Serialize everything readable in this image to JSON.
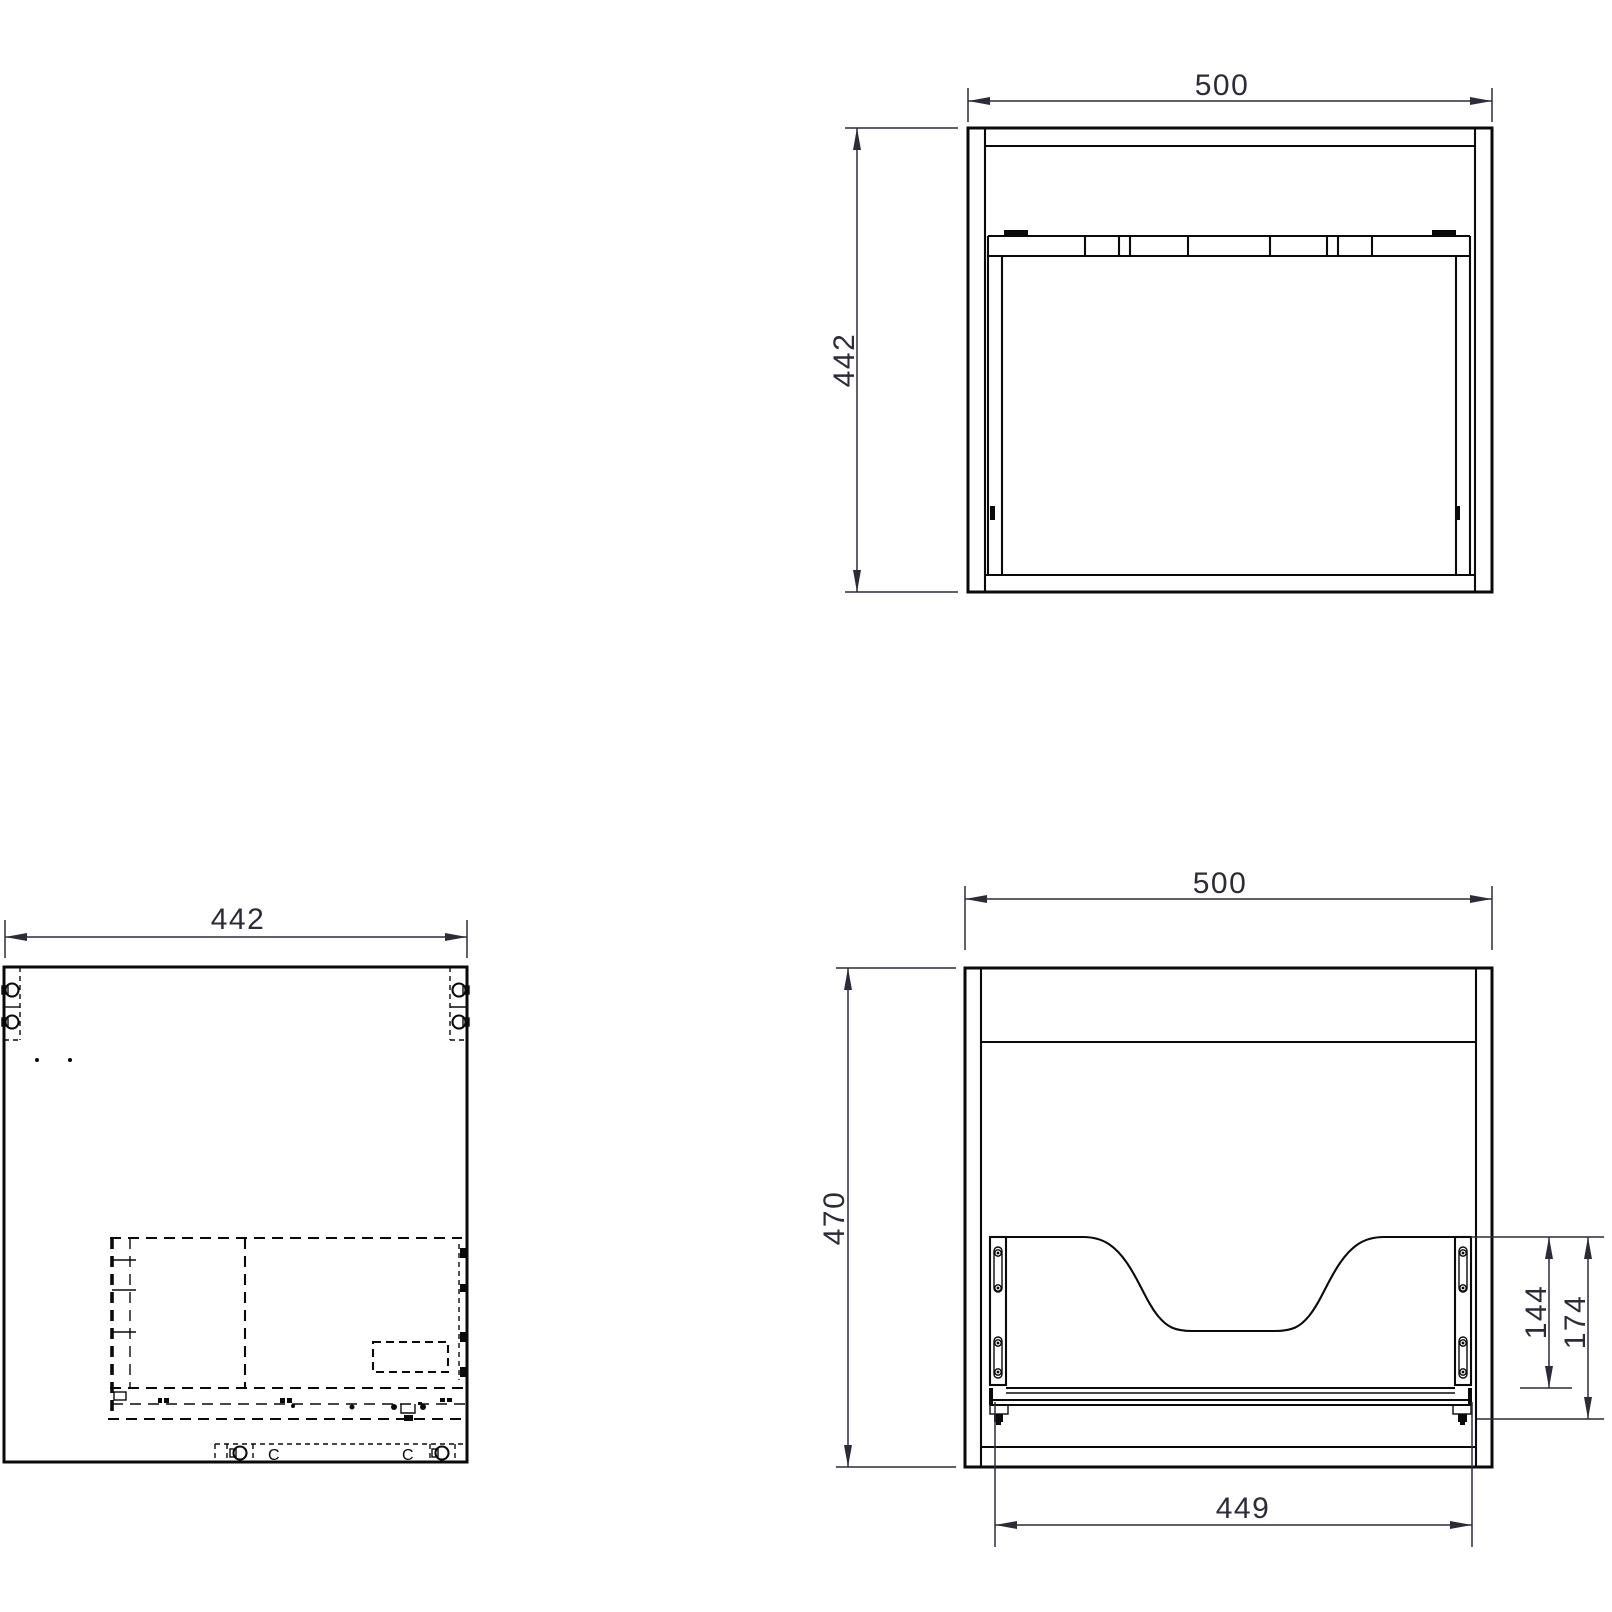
{
  "colors": {
    "geometry": "#0a0a0a",
    "dimension": "#2c2c38",
    "background": "#ffffff"
  },
  "icons": {
    "cam_lock": "circle-with-notch",
    "screw": "ringed-dot",
    "dimension_arrow": "slim-filled-triangle"
  },
  "views": {
    "top": {
      "dimensions": {
        "width": "500",
        "depth": "442"
      }
    },
    "side": {
      "dimensions": {
        "depth": "442"
      },
      "cam_letters": [
        "C",
        "C"
      ]
    },
    "front": {
      "dimensions": {
        "width": "500",
        "height": "470",
        "cutout_to_rail": "144",
        "cutout_to_base": "174",
        "inner_width": "449"
      }
    }
  }
}
